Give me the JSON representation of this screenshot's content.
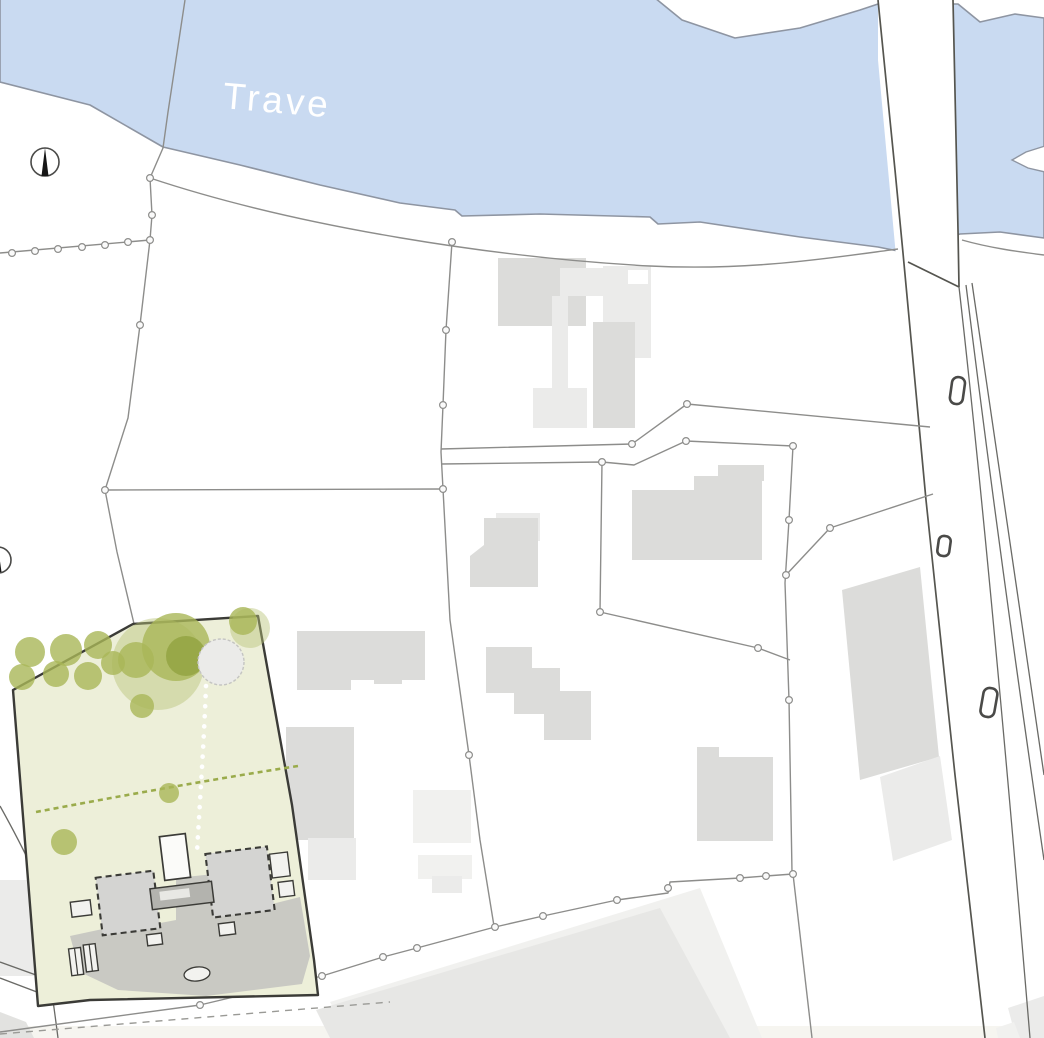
{
  "map": {
    "type": "architectural-site-plan",
    "labels": {
      "river": "Trave"
    },
    "colors": {
      "river": "#c9daf1",
      "shore": "#8e95a2",
      "parcel": "#8d8d8b",
      "roadline": "#55554f",
      "building": "#dcdcda",
      "site": "#edefd9",
      "paving": "#c5c5c1",
      "tree": "#a9b758",
      "outline": "#3b3b37",
      "label": "#ffffff"
    },
    "symbols": {
      "north_arrow": "north-arrow",
      "street_lamp": "street-lamp-symbol",
      "survey_node": "parcel-node"
    }
  }
}
